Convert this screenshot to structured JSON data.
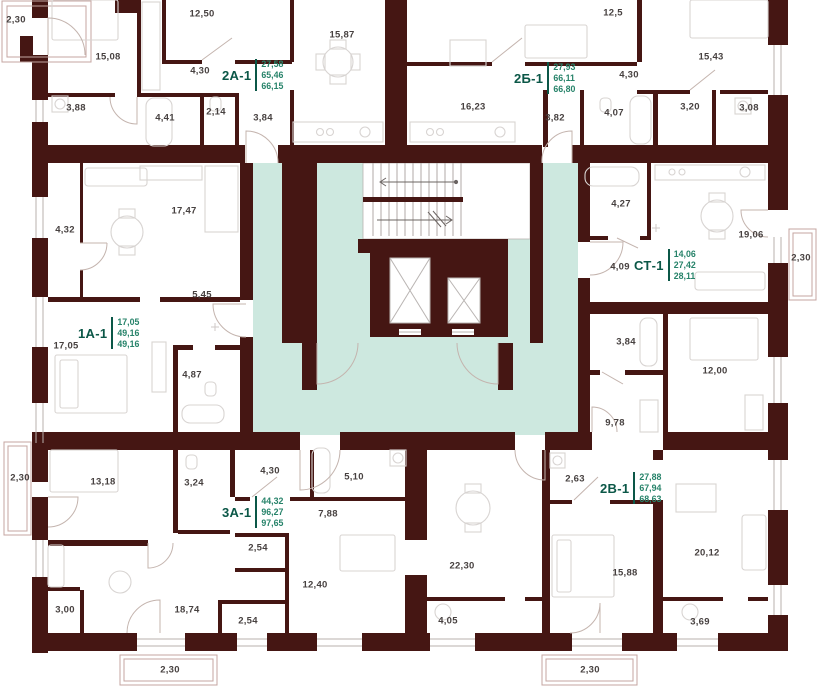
{
  "plan": {
    "type": "apartment-floor-plan",
    "colors": {
      "wall": "#451613",
      "core_fill": "#cde8df",
      "apartment_code_green": "#0b5747",
      "area_value_green": "#27836a",
      "room_label_gray": "#474140",
      "balcony_line": "#c4a5a0",
      "furniture_line": "#d8d4d2"
    },
    "core": {
      "stairs": "stairs-with-direction-arrows",
      "elevators": 2
    },
    "apartments": [
      {
        "code": "2A-1",
        "areas": [
          "27,58",
          "65,46",
          "66,15"
        ]
      },
      {
        "code": "2Б-1",
        "areas": [
          "27,93",
          "66,11",
          "66,80"
        ]
      },
      {
        "code": "1A-1",
        "areas": [
          "17,05",
          "49,16",
          "49,16"
        ]
      },
      {
        "code": "СТ-1",
        "areas": [
          "14,06",
          "27,42",
          "28,11"
        ]
      },
      {
        "code": "3A-1",
        "areas": [
          "44,32",
          "96,27",
          "97,65"
        ]
      },
      {
        "code": "2B-1",
        "areas": [
          "27,88",
          "67,94",
          "68,63"
        ]
      }
    ],
    "rooms": [
      "2,30",
      "12,50",
      "15,87",
      "12,5",
      "15,43",
      "15,08",
      "4,30",
      "4,30",
      "3,88",
      "4,41",
      "2,14",
      "3,84",
      "16,23",
      "3,82",
      "4,07",
      "3,20",
      "3,08",
      "17,47",
      "4,32",
      "4,27",
      "19,06",
      "2,30",
      "4,09",
      "5,45",
      "17,05",
      "3,84",
      "12,00",
      "4,87",
      "9,78",
      "13,18",
      "3,24",
      "4,30",
      "5,10",
      "2,63",
      "7,88",
      "2,54",
      "22,30",
      "15,88",
      "20,12",
      "12,40",
      "3,00",
      "18,74",
      "2,54",
      "4,05",
      "3,69",
      "2,30",
      "2,30",
      "2,30"
    ]
  }
}
